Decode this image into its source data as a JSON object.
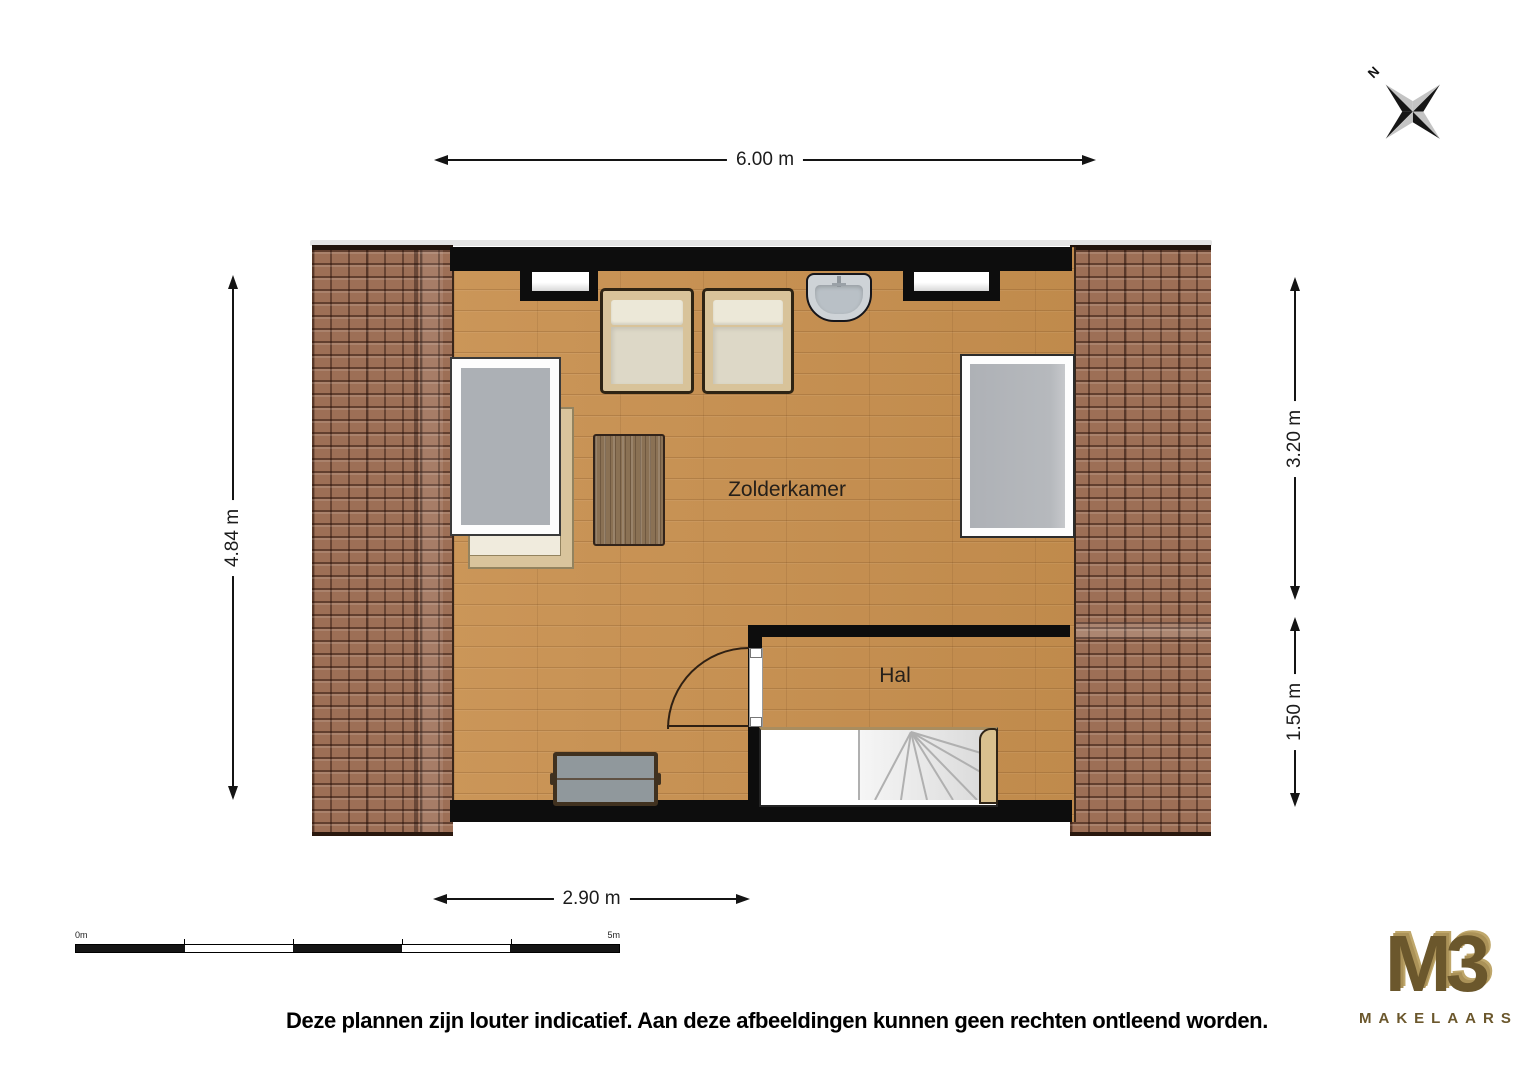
{
  "compass": {
    "label": "N"
  },
  "dimensions": {
    "top": "6.00 m",
    "left": "4.84 m",
    "right_top": "3.20 m",
    "right_bottom": "1.50 m",
    "bottom": "2.90 m"
  },
  "rooms": {
    "attic": "Zolderkamer",
    "hall": "Hal"
  },
  "furniture": [
    "armchair",
    "armchair",
    "wash-basin",
    "roof-window",
    "daybed",
    "coffee-table",
    "roof-window",
    "storage-bench",
    "winder-staircase",
    "door"
  ],
  "scale_bar": {
    "start_label": "0m",
    "end_label": "5m"
  },
  "disclaimer": "Deze plannen zijn louter indicatief. Aan deze afbeeldingen kunnen geen rechten ontleend worden.",
  "logo": {
    "title": "M3",
    "subtitle": "MAKELAARS"
  },
  "colors": {
    "roof_tile": "#9d6f56",
    "wood_floor": "#c8904f",
    "wall": "#0d0d0d",
    "glass": "#a9adb3",
    "logo_gold": "#6b572c"
  }
}
